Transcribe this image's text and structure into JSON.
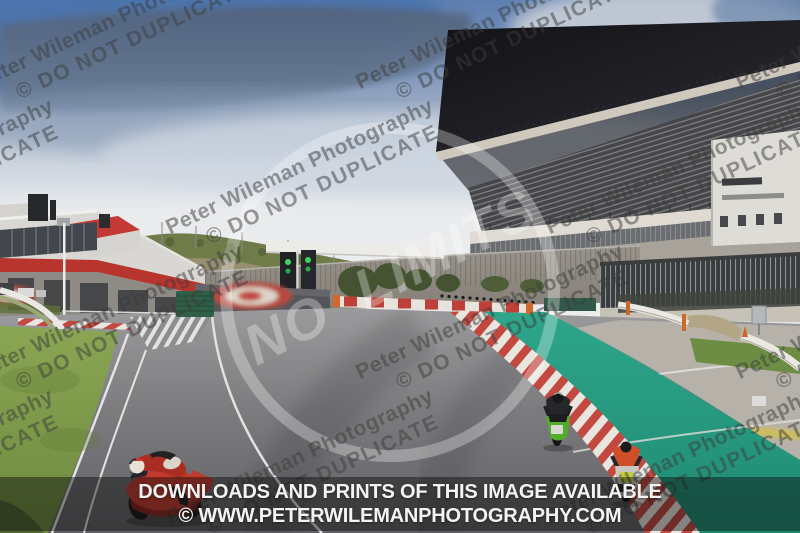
{
  "meta": {
    "type": "photograph",
    "subject": "motorcycle trackday at a race circuit with large grandstand",
    "dimensions": "800x533"
  },
  "watermark": {
    "line1": "Peter Wileman Photography",
    "line2": "© DO NOT DUPLICATE",
    "color": "rgba(60,60,60,0.5)"
  },
  "center_logo": {
    "text": "NO LIMITS",
    "shape": "circle-outline",
    "color": "rgba(255,255,255,0.30)"
  },
  "banner": {
    "line1": "DOWNLOADS AND PRINTS OF THIS IMAGE AVAILABLE",
    "line2": "© WWW.PETERWILEMANPHOTOGRAPHY.COM",
    "background": "rgba(12,12,12,0.45)",
    "text_color": "#f4f4f4"
  },
  "scene": {
    "sky": {
      "top_blue": "#4c73ac",
      "cloud_band": "#52637c",
      "haze": "#ebedef"
    },
    "track_asphalt": "#77777a",
    "runoff_teal": "#2ca287",
    "curb_red": "#c24840",
    "grass": "#87a352",
    "pit_building_stripe": "#b8352e",
    "grandstand_roof": "#17171b",
    "start_lights": {
      "state": "green",
      "color": "#3fd45f"
    },
    "motorcycles": [
      {
        "id": "red-bike",
        "color": "#c23a2c",
        "position": "bottom-left, leaning through corner"
      },
      {
        "id": "green-bike",
        "color": "#52ad2a",
        "position": "centre-right, upright"
      },
      {
        "id": "orange-rider-bike",
        "color": "#cf4f28",
        "position": "right, upright"
      }
    ]
  }
}
